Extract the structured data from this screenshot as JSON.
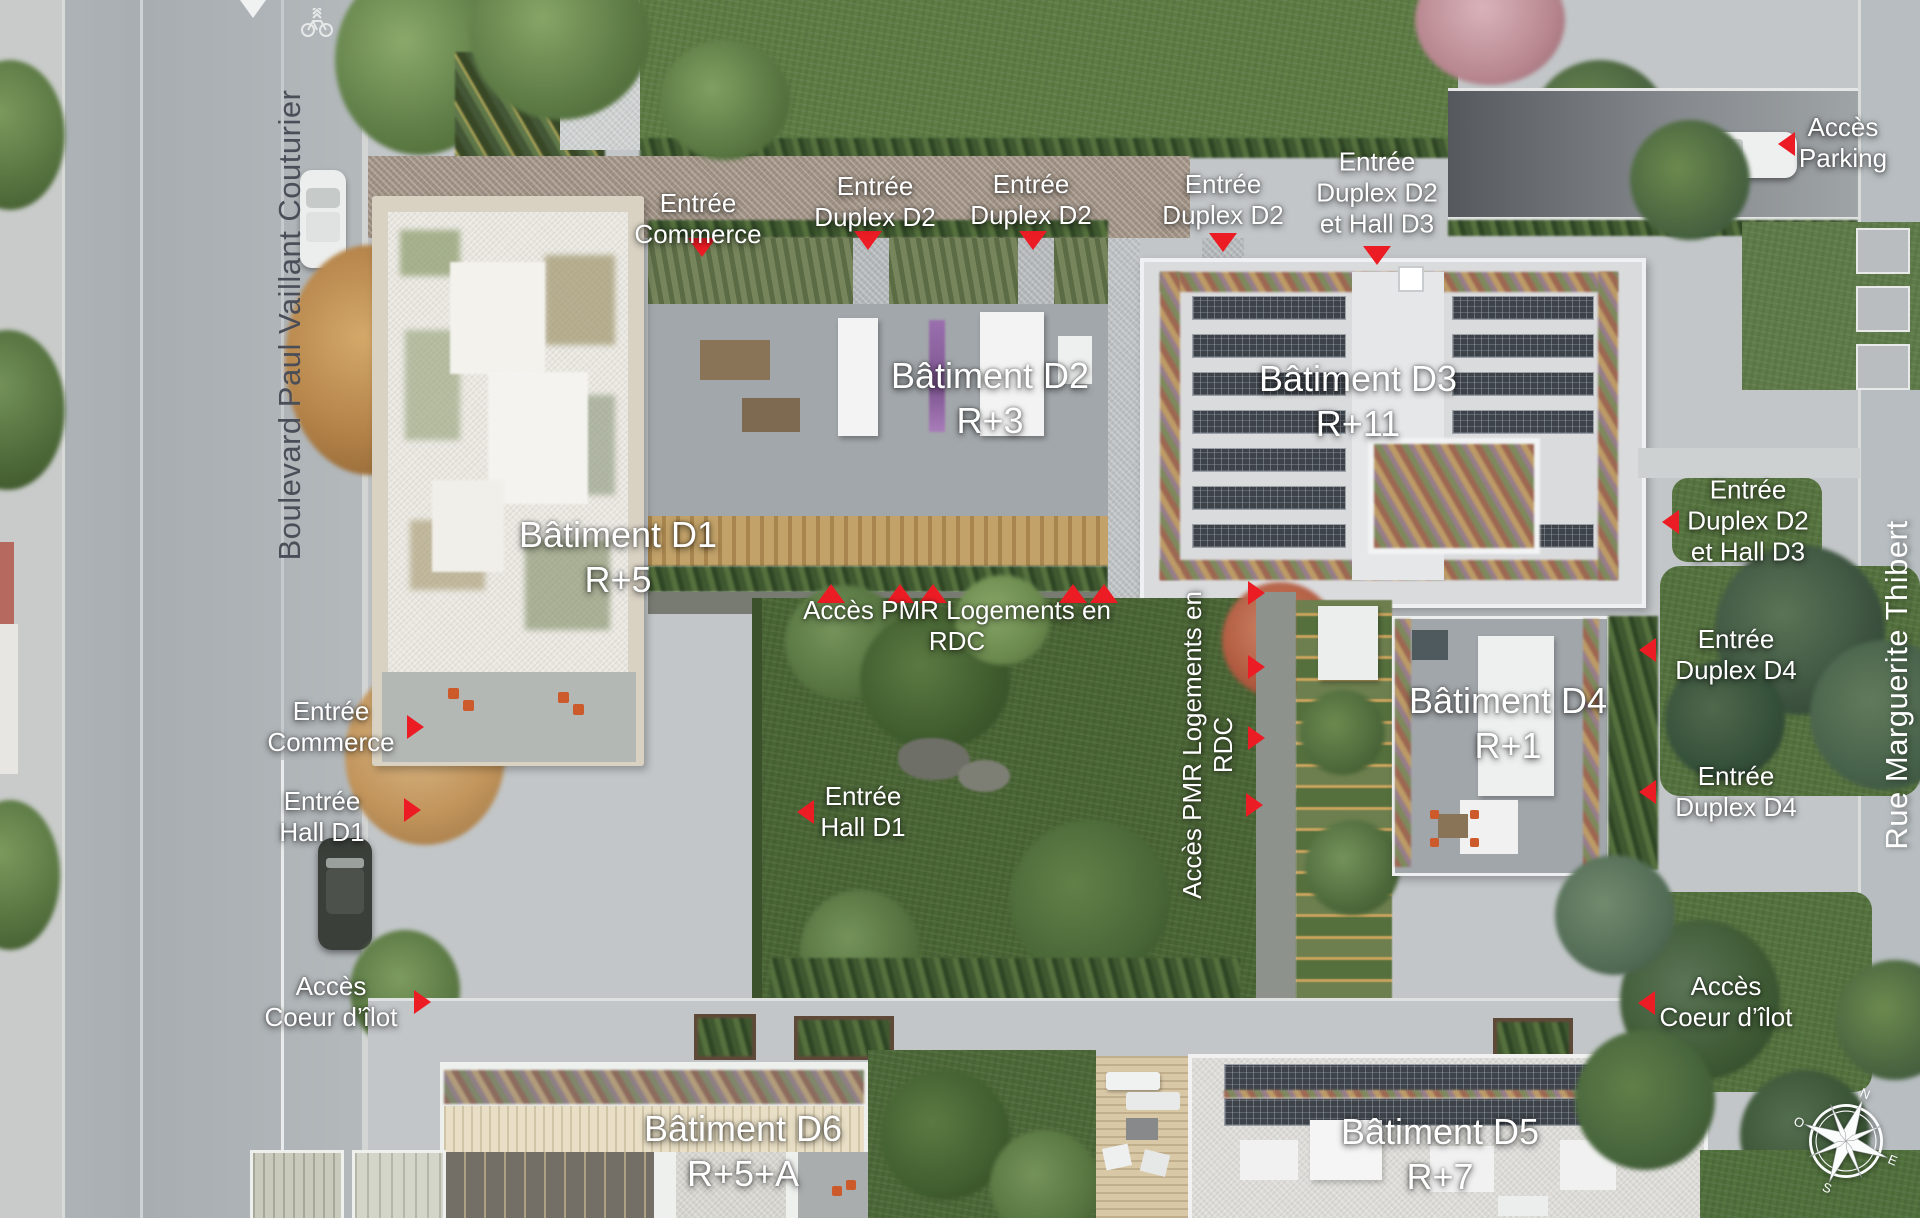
{
  "streets": {
    "left": "Boulevard Paul Vaillant Couturier",
    "right": "Rue Marguerite Thibert"
  },
  "buildings": {
    "d1": {
      "name": "Bâtiment D1",
      "floors": "R+5"
    },
    "d2": {
      "name": "Bâtiment D2",
      "floors": "R+3"
    },
    "d3": {
      "name": "Bâtiment D3",
      "floors": "R+11"
    },
    "d4": {
      "name": "Bâtiment D4",
      "floors": "R+1"
    },
    "d5": {
      "name": "Bâtiment D5",
      "floors": "R+7"
    },
    "d6": {
      "name": "Bâtiment D6",
      "floors": "R+5+A"
    }
  },
  "entrances": {
    "commerce": [
      "Entrée",
      "Commerce"
    ],
    "duplex_d2": [
      "Entrée",
      "Duplex D2"
    ],
    "duplex_d2_hall_d3": [
      "Entrée",
      "Duplex D2",
      "et Hall D3"
    ],
    "duplex_d4": [
      "Entrée",
      "Duplex D4"
    ],
    "hall_d1": [
      "Entrée",
      "Hall D1"
    ],
    "parking": [
      "Accès",
      "Parking"
    ],
    "coeur_ilot": [
      "Accès",
      "Coeur d’îlot"
    ],
    "pmr": [
      "Accès PMR Logements en",
      "RDC"
    ]
  },
  "compass": {
    "n": "N",
    "e": "E",
    "s": "S",
    "o": "O"
  },
  "colors": {
    "marker_red": "#ec1c24",
    "label_white": "#ffffff",
    "street_left_text": "#4a4e58",
    "lawn_green": "#5d7c44",
    "courtyard_tan": "#9f9183"
  }
}
